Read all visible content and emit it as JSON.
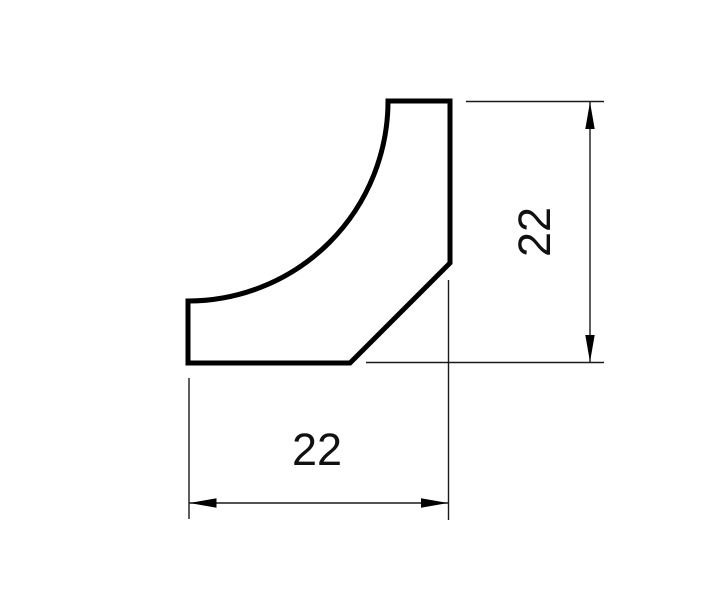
{
  "drawing": {
    "description": "Dimensioned cross-section profile with concave quarter-round cove",
    "background_color": "#ffffff",
    "outline_color": "#000000",
    "dimension_line_color": "#1a1a1a",
    "dimensions": {
      "width_label": "22",
      "height_label": "22"
    }
  }
}
